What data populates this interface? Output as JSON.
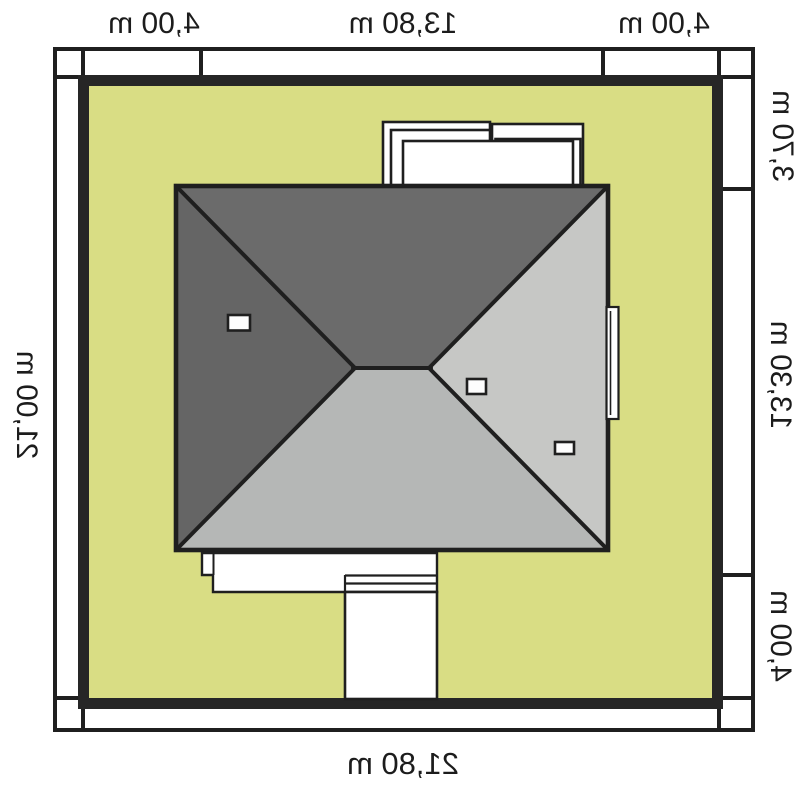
{
  "plan": {
    "type": "house-site-plan-roof-view-mirrored",
    "dimensions": {
      "top": [
        "4,00 m",
        "13,80 m",
        "4,00 m"
      ],
      "right": [
        "3,70 m",
        "13,30 m",
        "4,00 m"
      ],
      "bottom": "21,80 m",
      "left": "21,00 m"
    },
    "colors": {
      "plot_fill": "#d9dd84",
      "line": "#1f1f1f",
      "boundary": "#262626",
      "roof_left_face": "#656565",
      "roof_top_face": "#6b6b6b",
      "roof_right_face": "#c6c7c5",
      "roof_bottom_face": "#b5b7b6",
      "structure_fill": "#ffffff"
    }
  }
}
